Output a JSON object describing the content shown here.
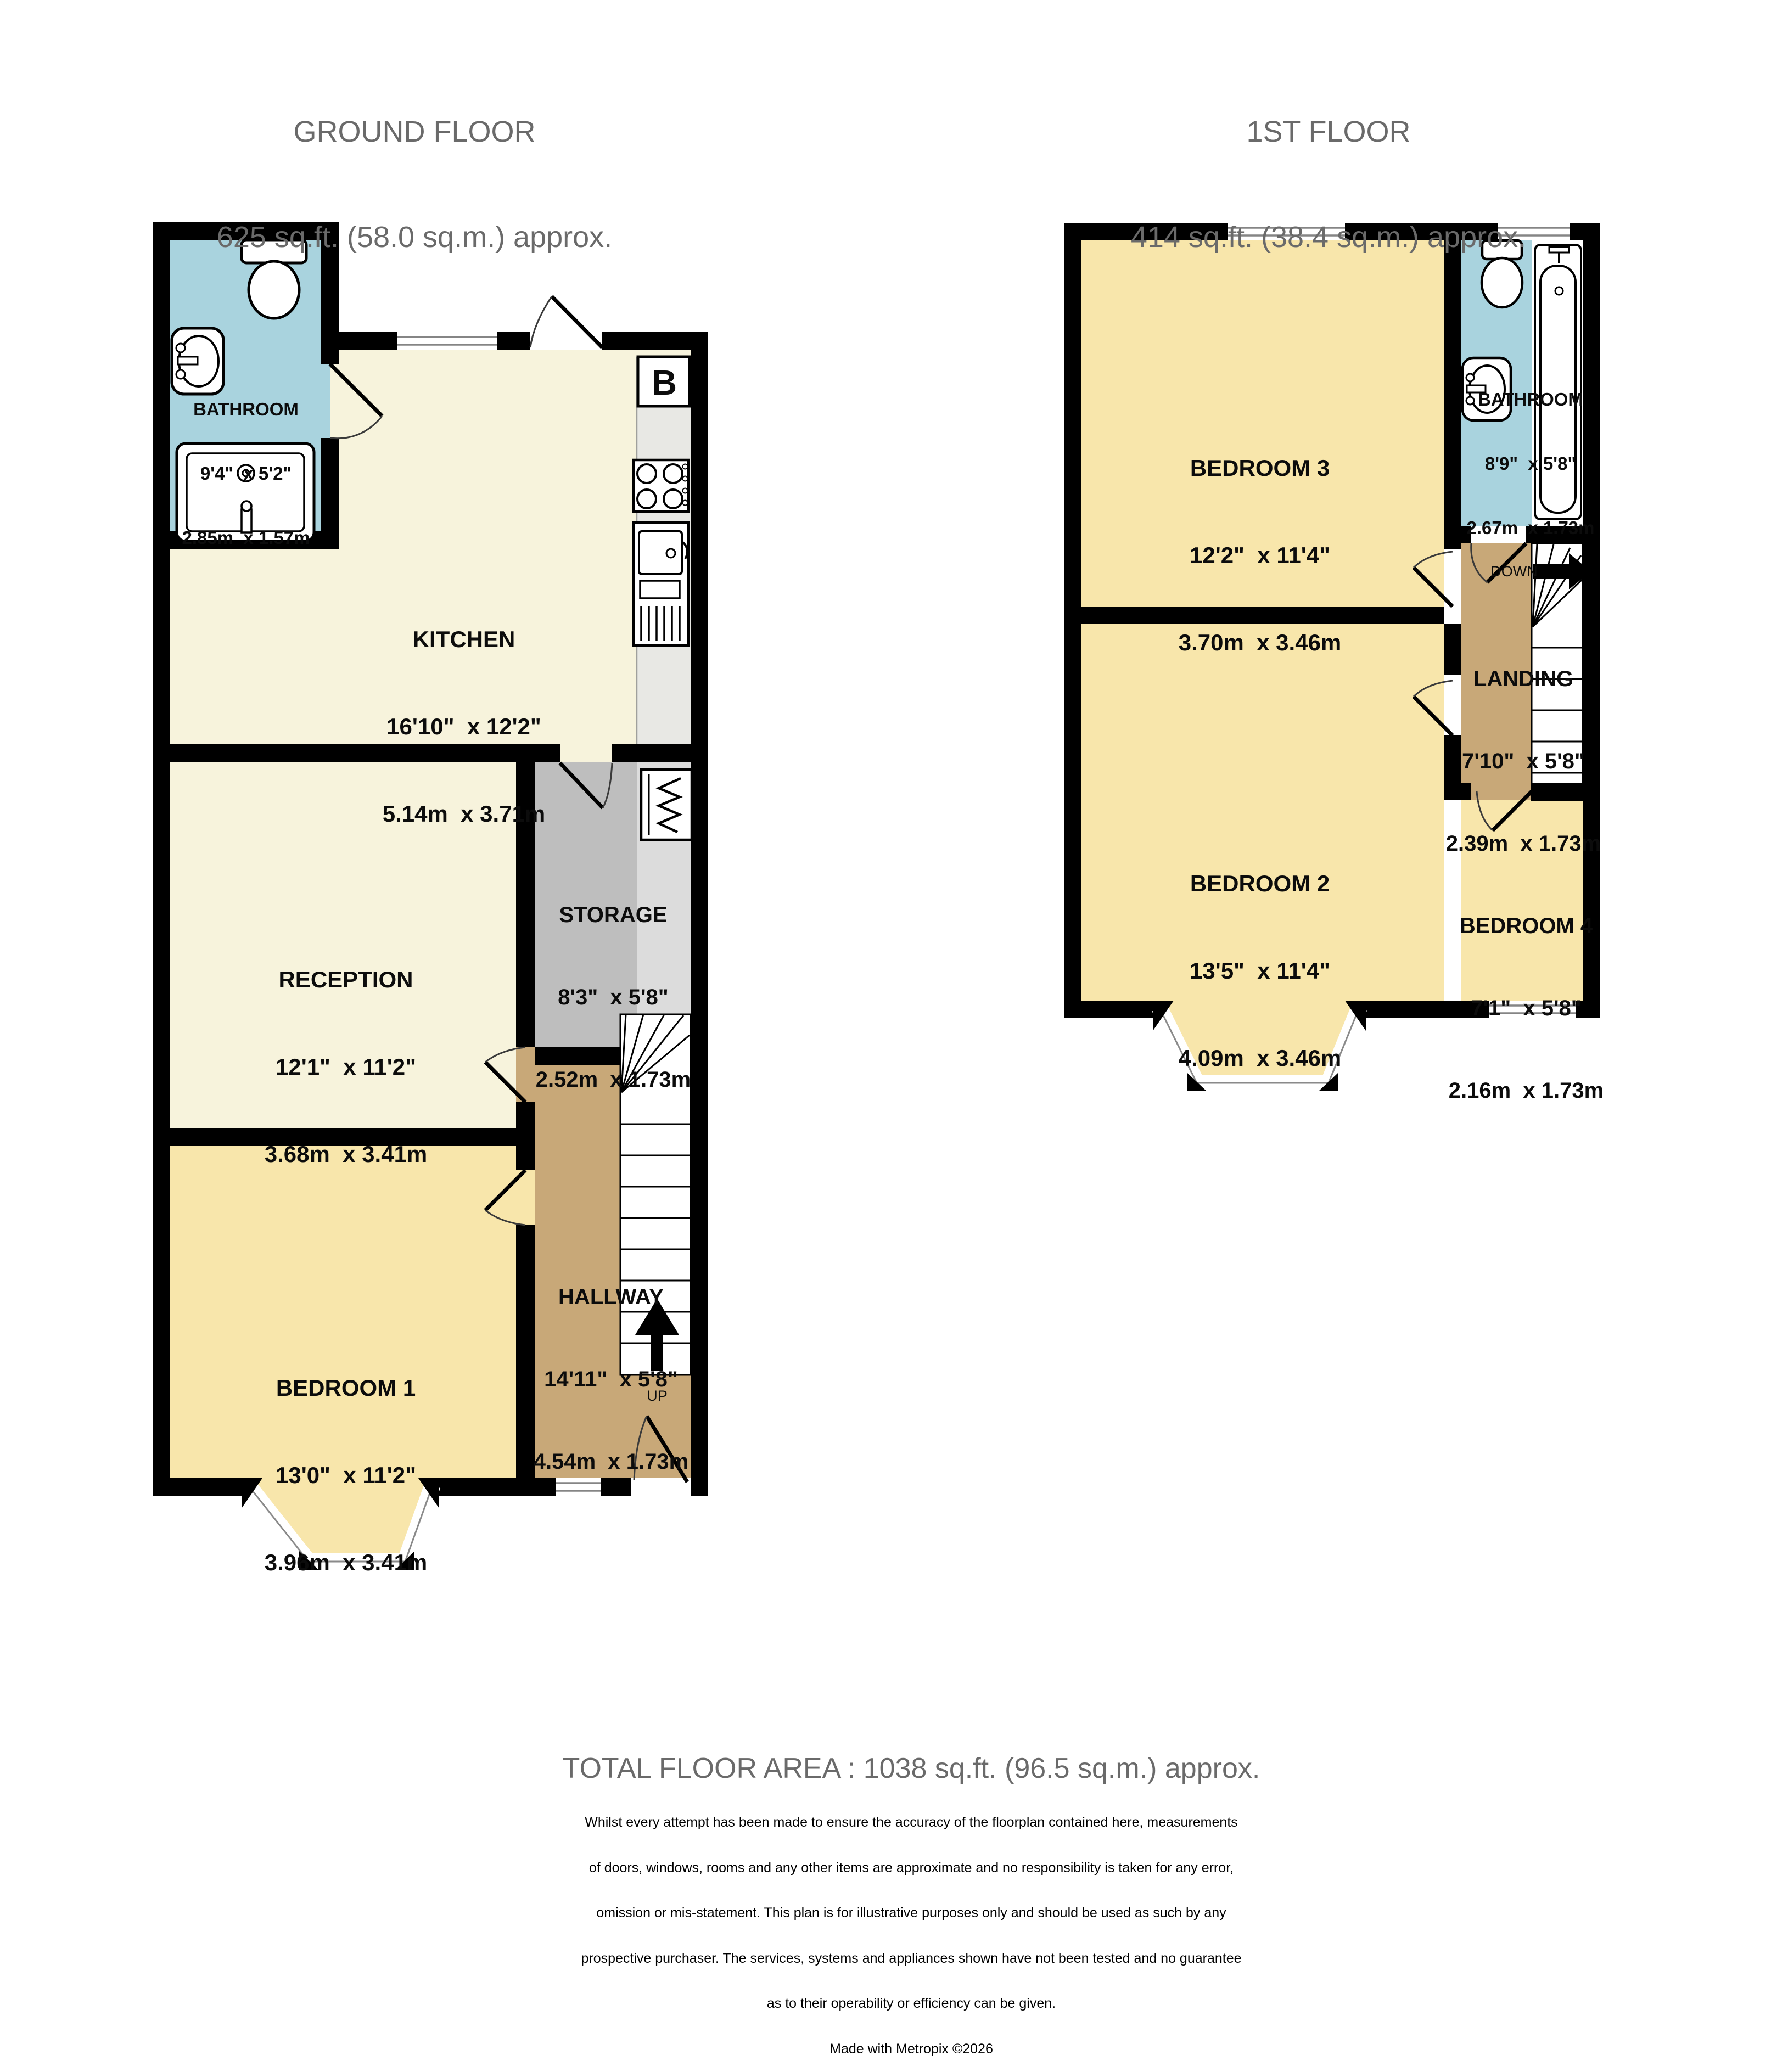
{
  "headers": {
    "ground": {
      "title": "GROUND FLOOR",
      "area": "625 sq.ft. (58.0 sq.m.) approx."
    },
    "first": {
      "title": "1ST FLOOR",
      "area": "414 sq.ft. (38.4 sq.m.) approx."
    }
  },
  "ground_floor": {
    "rooms": [
      {
        "name": "BATHROOM",
        "imperial": "9'4\"  x 5'2\"",
        "metric": "2.85m  x 1.57m"
      },
      {
        "name": "KITCHEN",
        "imperial": "16'10\"  x 12'2\"",
        "metric": "5.14m  x 3.71m"
      },
      {
        "name": "RECEPTION",
        "imperial": "12'1\"  x 11'2\"",
        "metric": "3.68m  x 3.41m"
      },
      {
        "name": "STORAGE",
        "imperial": "8'3\"  x 5'8\"",
        "metric": "2.52m  x 1.73m"
      },
      {
        "name": "HALLWAY",
        "imperial": "14'11\"  x 5'8\"",
        "metric": "4.54m  x 1.73m"
      },
      {
        "name": "BEDROOM 1",
        "imperial": "13'0\"  x 11'2\"",
        "metric": "3.96m  x 3.41m"
      }
    ],
    "annotations": {
      "boiler": "B",
      "up": "UP"
    }
  },
  "first_floor": {
    "rooms": [
      {
        "name": "BEDROOM 3",
        "imperial": "12'2\"  x 11'4\"",
        "metric": "3.70m  x 3.46m"
      },
      {
        "name": "BATHROOM",
        "imperial": "8'9\"  x 5'8\"",
        "metric": "2.67m  x 1.73m"
      },
      {
        "name": "LANDING",
        "imperial": "7'10\"  x 5'8\"",
        "metric": "2.39m  x 1.73m"
      },
      {
        "name": "BEDROOM 2",
        "imperial": "13'5\"  x 11'4\"",
        "metric": "4.09m  x 3.46m"
      },
      {
        "name": "BEDROOM 4",
        "imperial": "7'1\"  x 5'8\"",
        "metric": "2.16m  x 1.73m"
      }
    ],
    "annotations": {
      "down": "DOWN"
    }
  },
  "footer": {
    "total": "TOTAL FLOOR AREA : 1038 sq.ft. (96.5 sq.m.) approx.",
    "disclaimer": [
      "Whilst every attempt has been made to ensure the accuracy of the floorplan contained here, measurements",
      "of doors, windows, rooms and any other items are approximate and no responsibility is taken for any error,",
      "omission or mis-statement. This plan is for illustrative purposes only and should be used as such by any",
      "prospective purchaser. The services, systems and appliances shown have not been tested and no guarantee",
      "as to their operability or efficiency can be given."
    ],
    "credit": "Made with Metropix ©2026"
  },
  "colors": {
    "wall": "#000000",
    "cream": "#F7F3DC",
    "yellow": "#F8E6AB",
    "blue": "#A9D3DE",
    "tan": "#C8A878",
    "storage_dark": "#BEBEBE",
    "storage_light": "#DCDCDC",
    "counter": "#E8E8E4"
  }
}
